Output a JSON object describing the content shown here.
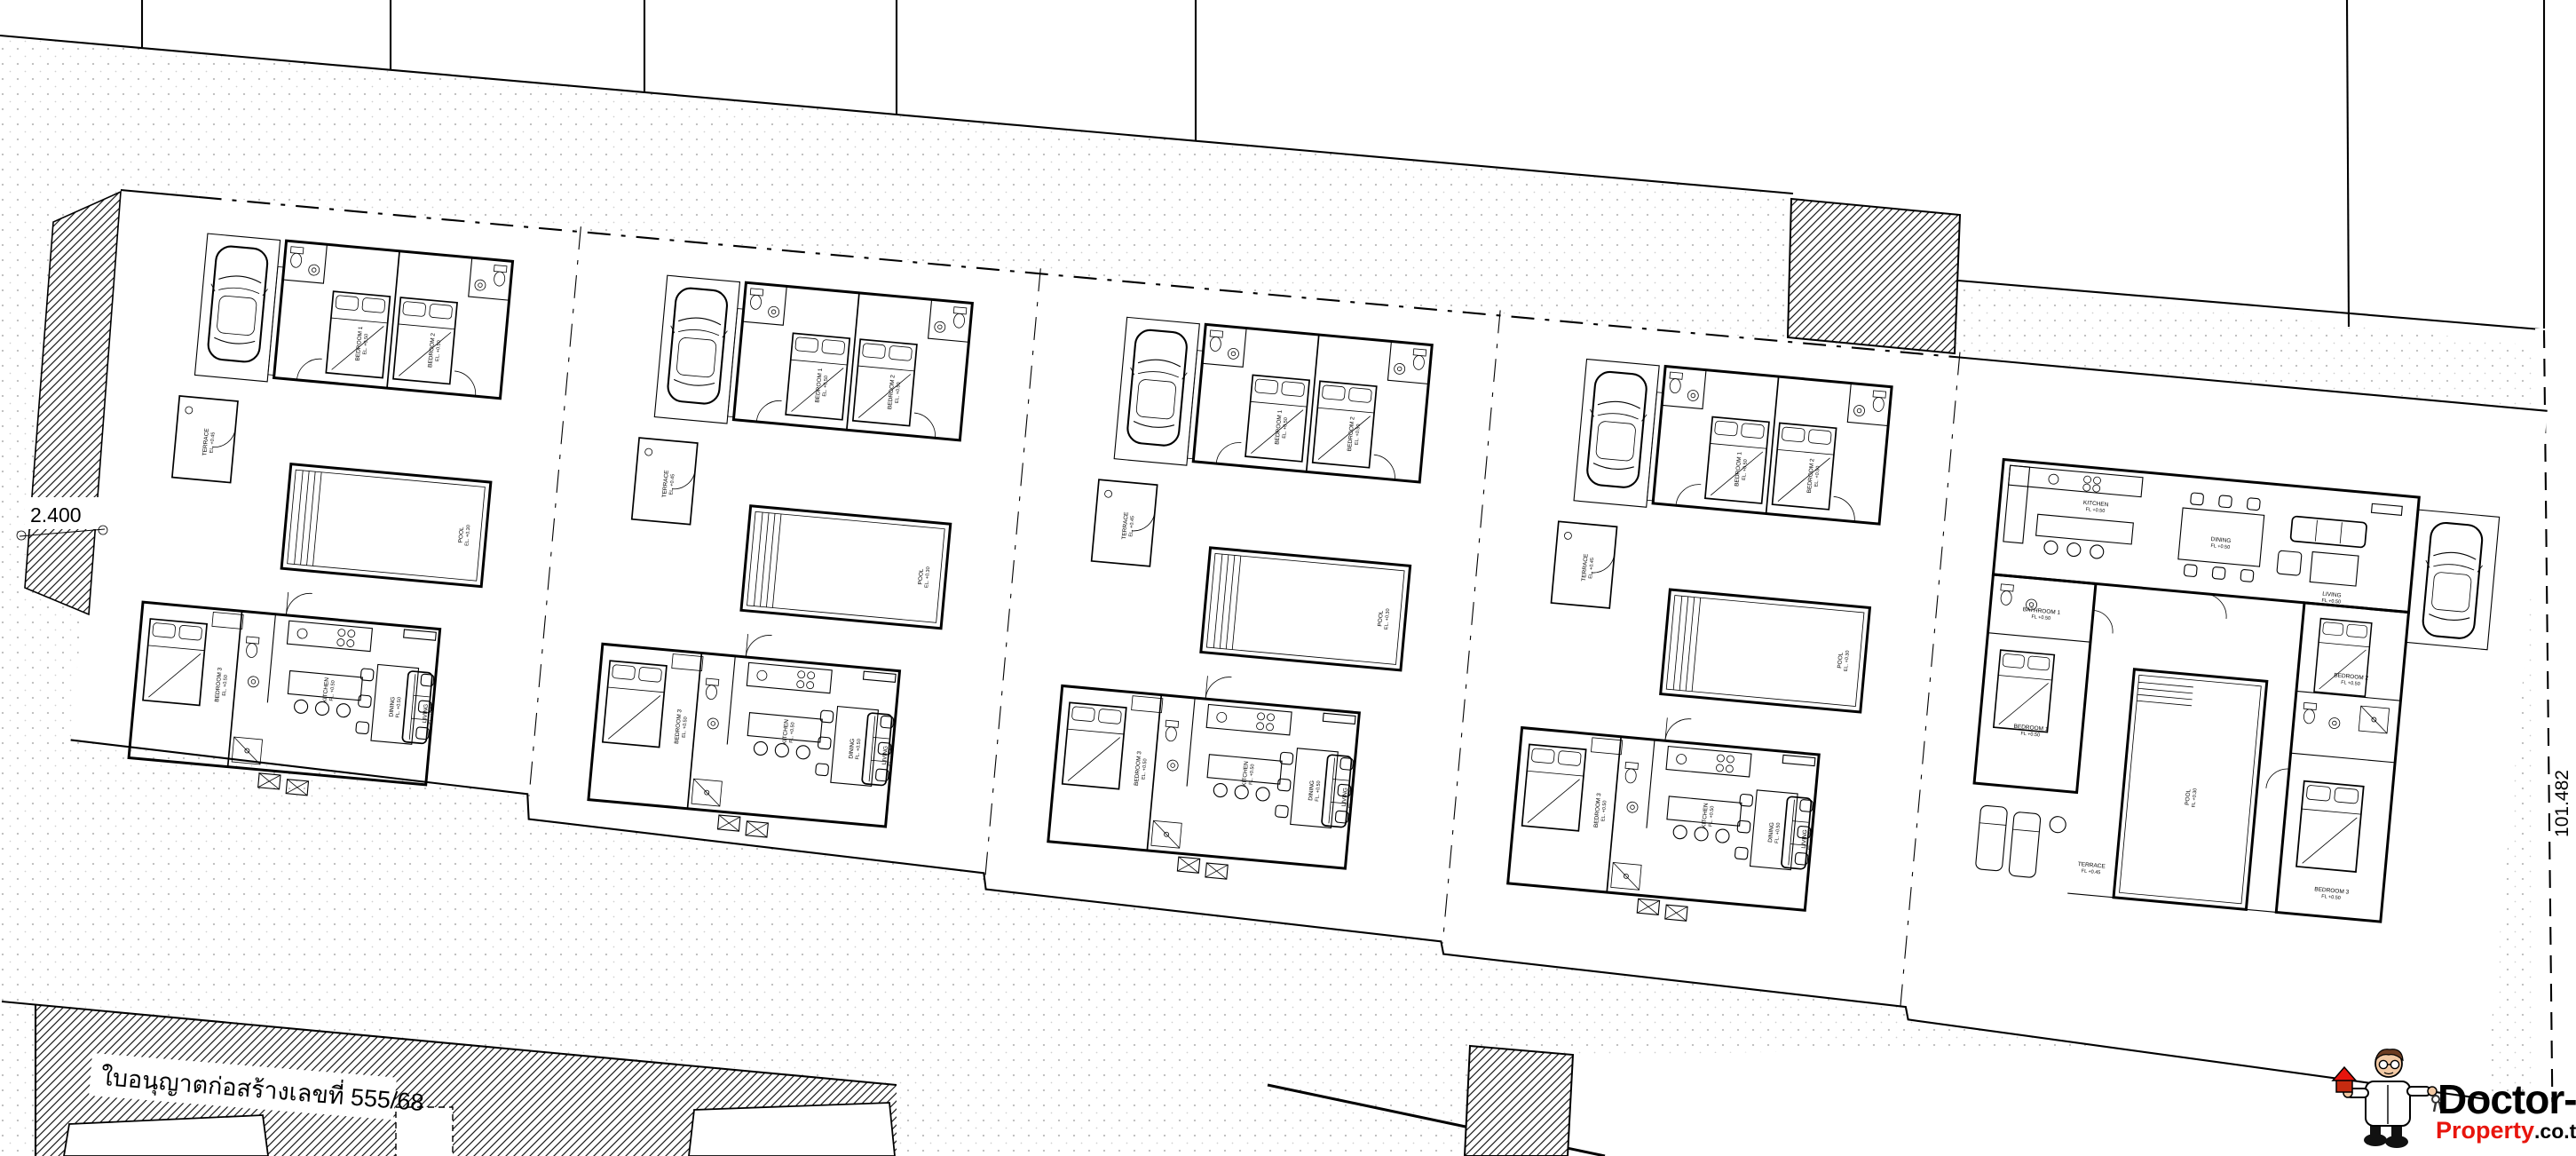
{
  "document": {
    "type": "architectural-site-plan",
    "description": "Site plan of 5 pool villas with surrounding parcels and roads"
  },
  "annotations": {
    "permit_text": "ใบอนุญาตก่อสร้างเลขที่  555/68",
    "dim_left": "2.400",
    "dim_right": "101.482"
  },
  "logo": {
    "title": "Doctor-",
    "line2_red": "Property",
    "line2_black": ".co.th"
  },
  "site": {
    "plot_count": 5,
    "standard_villa_count": 4
  },
  "villa_standard": {
    "rooms": {
      "bedroom1": {
        "label": "BEDROOM 1",
        "elev": "EL. +0.50"
      },
      "bedroom2": {
        "label": "BEDROOM 2",
        "elev": "EL. +0.50"
      },
      "terrace": {
        "label": "TERRACE",
        "elev": "EL. +0.45"
      },
      "pool": {
        "label": "POOL",
        "elev": "EL. +0.30"
      },
      "bedroom3": {
        "label": "BEDROOM 3",
        "elev": "EL. +0.50"
      },
      "kitchen": {
        "label": "KITCHEN",
        "elev": "FL. +0.50"
      },
      "dining": {
        "label": "DINING",
        "elev": "FL. +0.50"
      },
      "living": {
        "label": "LIVING",
        "elev": "FL. +0.50"
      }
    }
  },
  "villa_type2": {
    "rooms": {
      "kitchen": {
        "label": "KITCHEN",
        "elev": "FL +0.50"
      },
      "dining": {
        "label": "DINING",
        "elev": "FL +0.50"
      },
      "living": {
        "label": "LIVING",
        "elev": "FL +0.50"
      },
      "bathroom1": {
        "label": "BATHROOM 1",
        "elev": "FL +0.50"
      },
      "bedroom1": {
        "label": "BEDROOM 1",
        "elev": "FL +0.50"
      },
      "bedroom2": {
        "label": "BEDROOM 2",
        "elev": "FL +0.50"
      },
      "bedroom3": {
        "label": "BEDROOM 3",
        "elev": "FL +0.50"
      },
      "pool": {
        "label": "POOL",
        "elev": "FL +0.30"
      },
      "terrace": {
        "label": "TERRACE",
        "elev": "FL +0.45"
      }
    }
  },
  "colors": {
    "ink": "#000000",
    "paper": "#ffffff",
    "dots": "#c0c0c0",
    "logo_red": "#e8150d",
    "skin": "#f2c9a4",
    "hair": "#6b3c22"
  }
}
